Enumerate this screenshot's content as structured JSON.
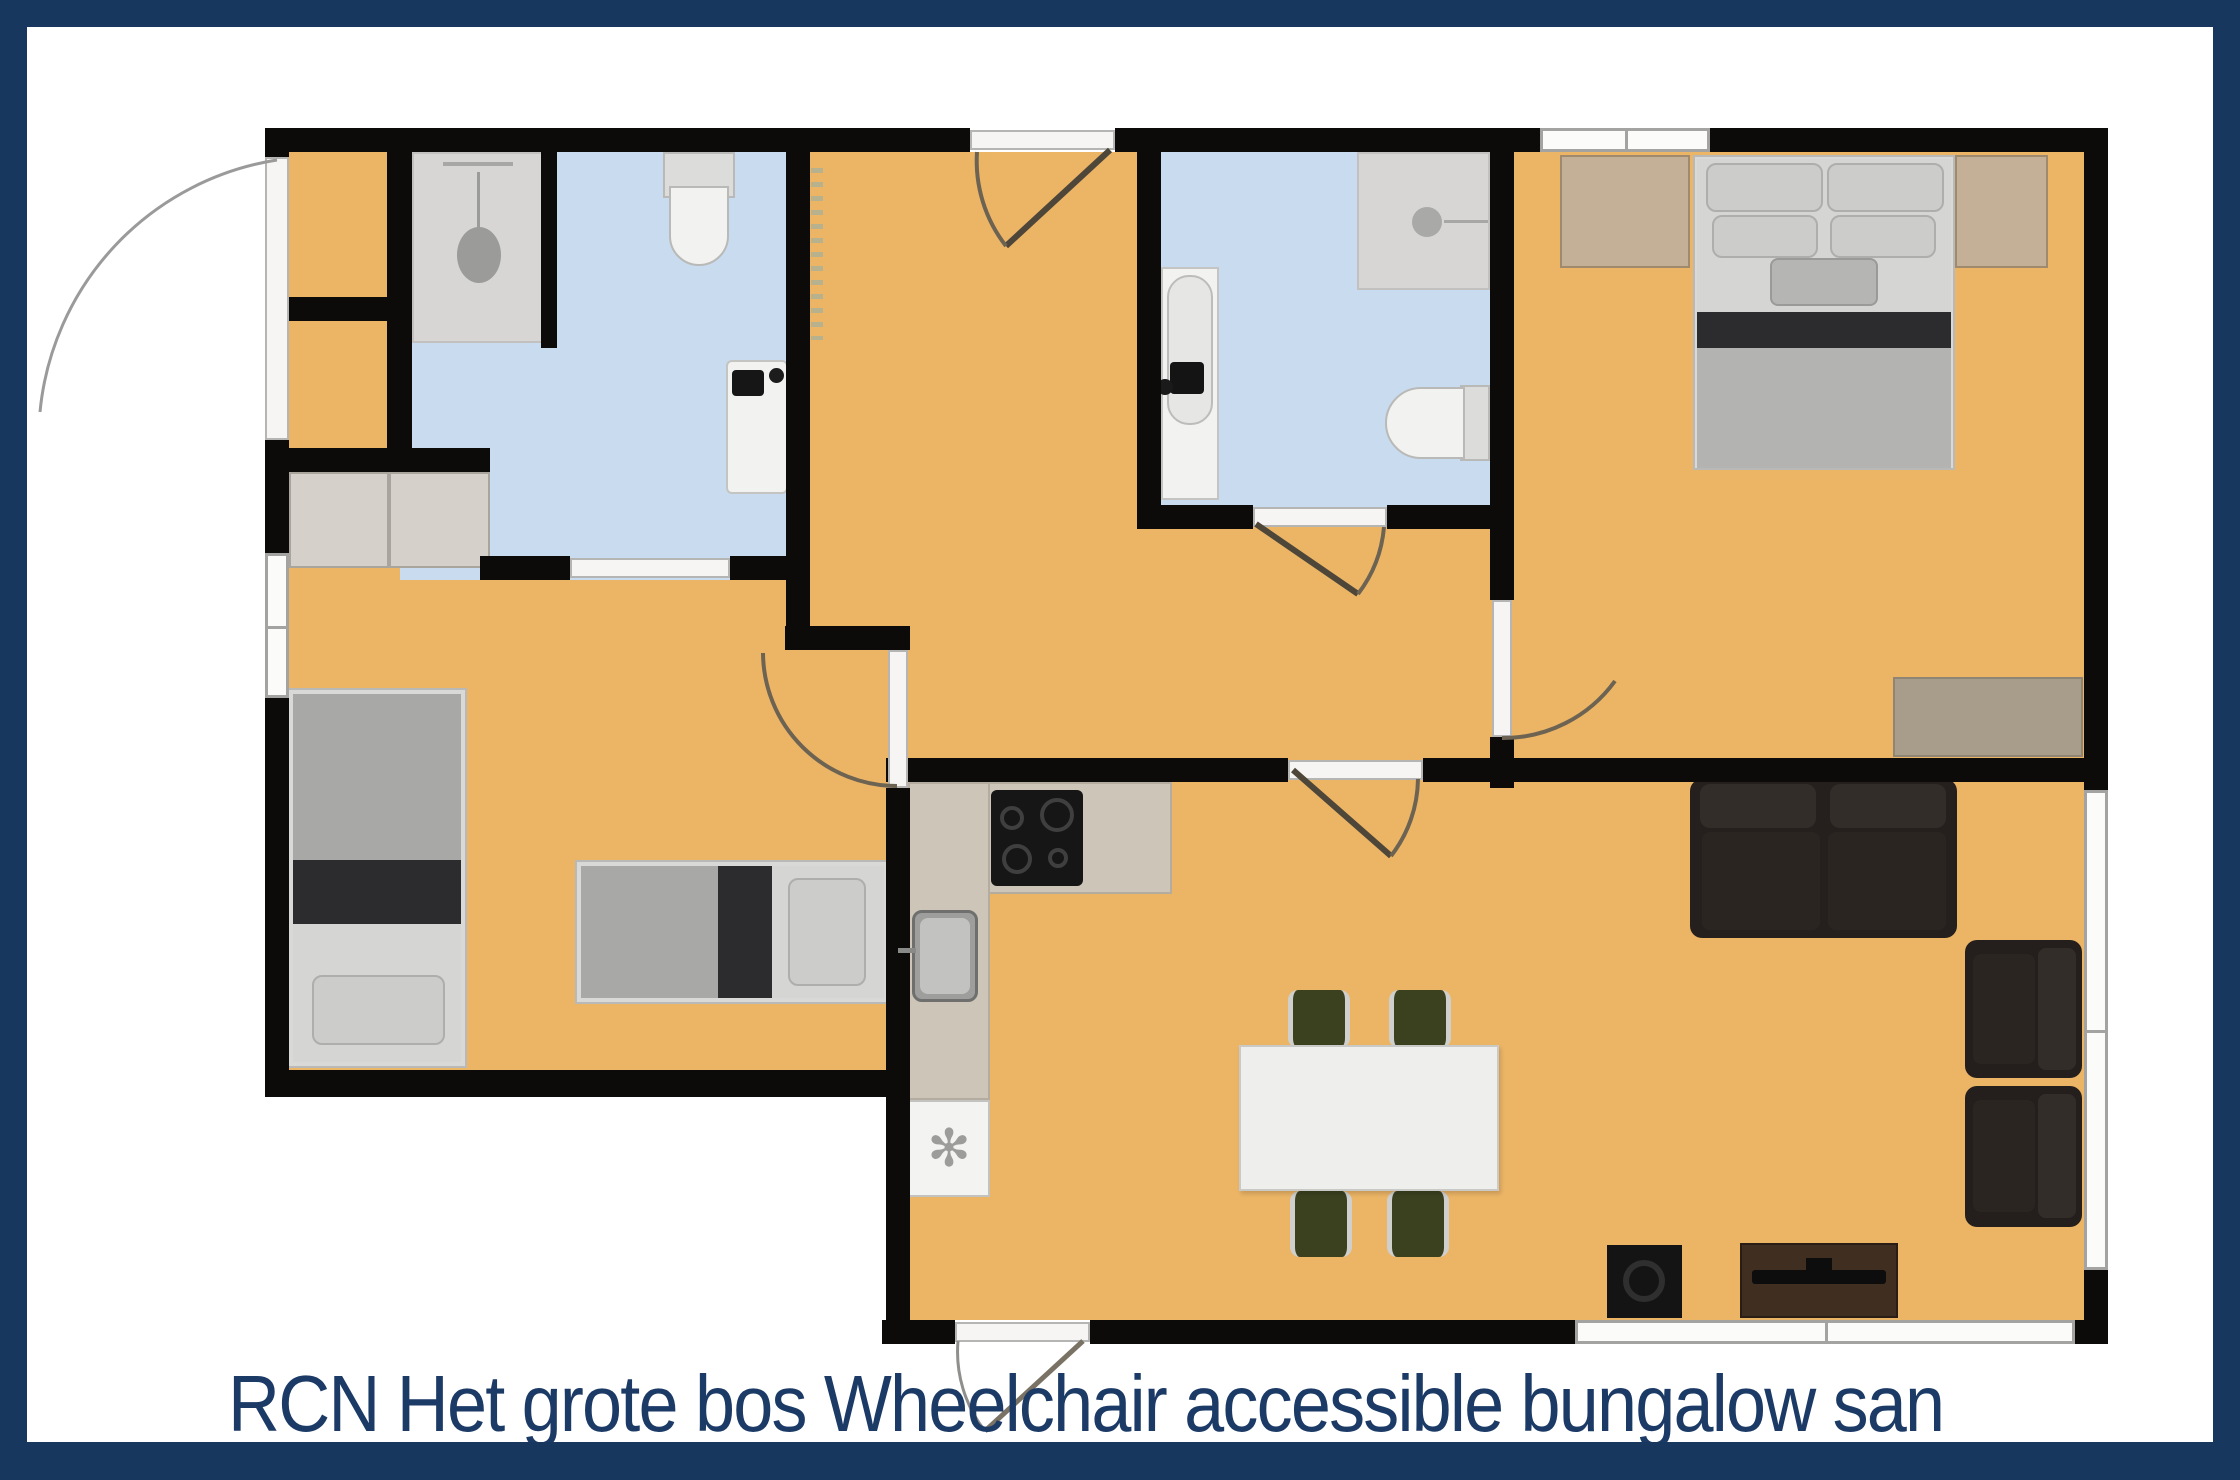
{
  "caption": {
    "text": "RCN Het grote bos Wheelchair accessible bungalow san"
  },
  "icons": {
    "dishwasher_glyph": "✻"
  },
  "colors": {
    "frame_navy": "#17375e",
    "caption_text": "#1b3a66",
    "floor_orange": "#ecb566",
    "bath_blue": "#c9dbee",
    "wall_black": "#0c0b0a",
    "shower_gray": "#d7d6d4",
    "counter_stone": "#cdc5b8",
    "wood_tan": "#c4b097",
    "dresser_wood": "#a79d8a",
    "sofa_brown": "#25201e",
    "chair_olive": "#3b411f",
    "window_white": "#fbfbfa",
    "door_white": "#f6f5f3",
    "metal_gray": "#9e9e9c",
    "appliance_white": "#f3f3f1",
    "table_white": "#eeeeec",
    "bed_gray": "#a8a8a6",
    "bed_dark": "#2c2c2e",
    "bed_sheet": "#d5d5d3",
    "tv_brown": "#402f20",
    "fixture_white": "#f2f2f0"
  }
}
